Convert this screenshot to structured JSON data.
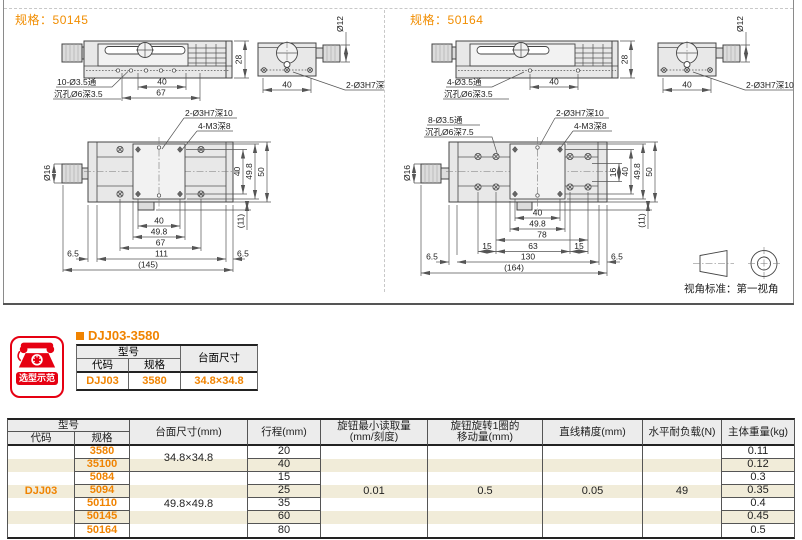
{
  "colors": {
    "accent_orange": "#f08300",
    "badge_red": "#e60012",
    "stripe_cream": "#f1ecd9",
    "header_gray": "#ececec"
  },
  "panels": [
    {
      "spec_label": "规格：",
      "spec_no": "50145",
      "side": {
        "through": "10-Ø3.5通",
        "sink": "沉孔Ø6深3.5",
        "d40": "40",
        "d67": "67",
        "d28": "28"
      },
      "end": {
        "dia": "Ø12",
        "d40": "40",
        "pin": "2-Ø3H7深10"
      },
      "top": {
        "pin": "2-Ø3H7深10",
        "tap": "4-M3深8",
        "knob": "Ø16",
        "v40": "40",
        "v49": "49.8",
        "v50": "50",
        "v11": "(11)",
        "b40": "40",
        "b49": "49.8",
        "b67": "67",
        "b111": "111",
        "b65l": "6.5",
        "b65r": "6.5",
        "btot": "(145)"
      }
    },
    {
      "spec_label": "规格：",
      "spec_no": "50164",
      "side": {
        "through": "4-Ø3.5通",
        "sink": "沉孔Ø6深3.5",
        "d40": "40",
        "d28": "28"
      },
      "end": {
        "dia": "Ø12",
        "d40": "40",
        "pin": "2-Ø3H7深10"
      },
      "top": {
        "through": "8-Ø3.5通",
        "sink": "沉孔Ø6深7.5",
        "pin": "2-Ø3H7深10",
        "tap": "4-M3深8",
        "knob": "Ø16",
        "v16": "16",
        "v40": "40",
        "v49": "49.8",
        "v50": "50",
        "v11": "(11)",
        "b40": "40",
        "b49": "49.8",
        "b78": "78",
        "b15l": "15",
        "b63": "63",
        "b15r": "15",
        "b130": "130",
        "b65l": "6.5",
        "b65r": "6.5",
        "btot": "(164)"
      }
    }
  ],
  "view_note": "视角标准：第一视角",
  "badge": {
    "label": "选型示范"
  },
  "example": {
    "title": "DJJ03-3580",
    "headers": {
      "model": "型号",
      "code": "代码",
      "spec": "规格",
      "surface": "台面尺寸"
    },
    "row": {
      "code": "DJJ03",
      "spec": "3580",
      "surface": "34.8×34.8"
    }
  },
  "spec_table": {
    "headers": {
      "model": "型号",
      "code": "代码",
      "spec": "规格",
      "surface": "台面尺寸(mm)",
      "travel": "行程(mm)",
      "min_reading_1": "旋钮最小读取量",
      "min_reading_2": "(mm/刻度)",
      "per_turn_1": "旋钮旋转1圈的",
      "per_turn_2": "移动量(mm)",
      "accuracy": "直线精度(mm)",
      "load": "水平耐负载(N)",
      "weight": "主体重量(kg)"
    },
    "code": "DJJ03",
    "surface_groups": [
      {
        "value": "34.8×34.8"
      },
      {
        "value": "49.8×49.8"
      }
    ],
    "min_reading": "0.01",
    "per_turn": "0.5",
    "accuracy": "0.05",
    "load": "49",
    "rows": [
      {
        "spec": "3580",
        "travel": "20",
        "weight": "0.11"
      },
      {
        "spec": "35100",
        "travel": "40",
        "weight": "0.12"
      },
      {
        "spec": "5084",
        "travel": "15",
        "weight": "0.3"
      },
      {
        "spec": "5094",
        "travel": "25",
        "weight": "0.35"
      },
      {
        "spec": "50110",
        "travel": "35",
        "weight": "0.4"
      },
      {
        "spec": "50145",
        "travel": "60",
        "weight": "0.45"
      },
      {
        "spec": "50164",
        "travel": "80",
        "weight": "0.5"
      }
    ]
  }
}
